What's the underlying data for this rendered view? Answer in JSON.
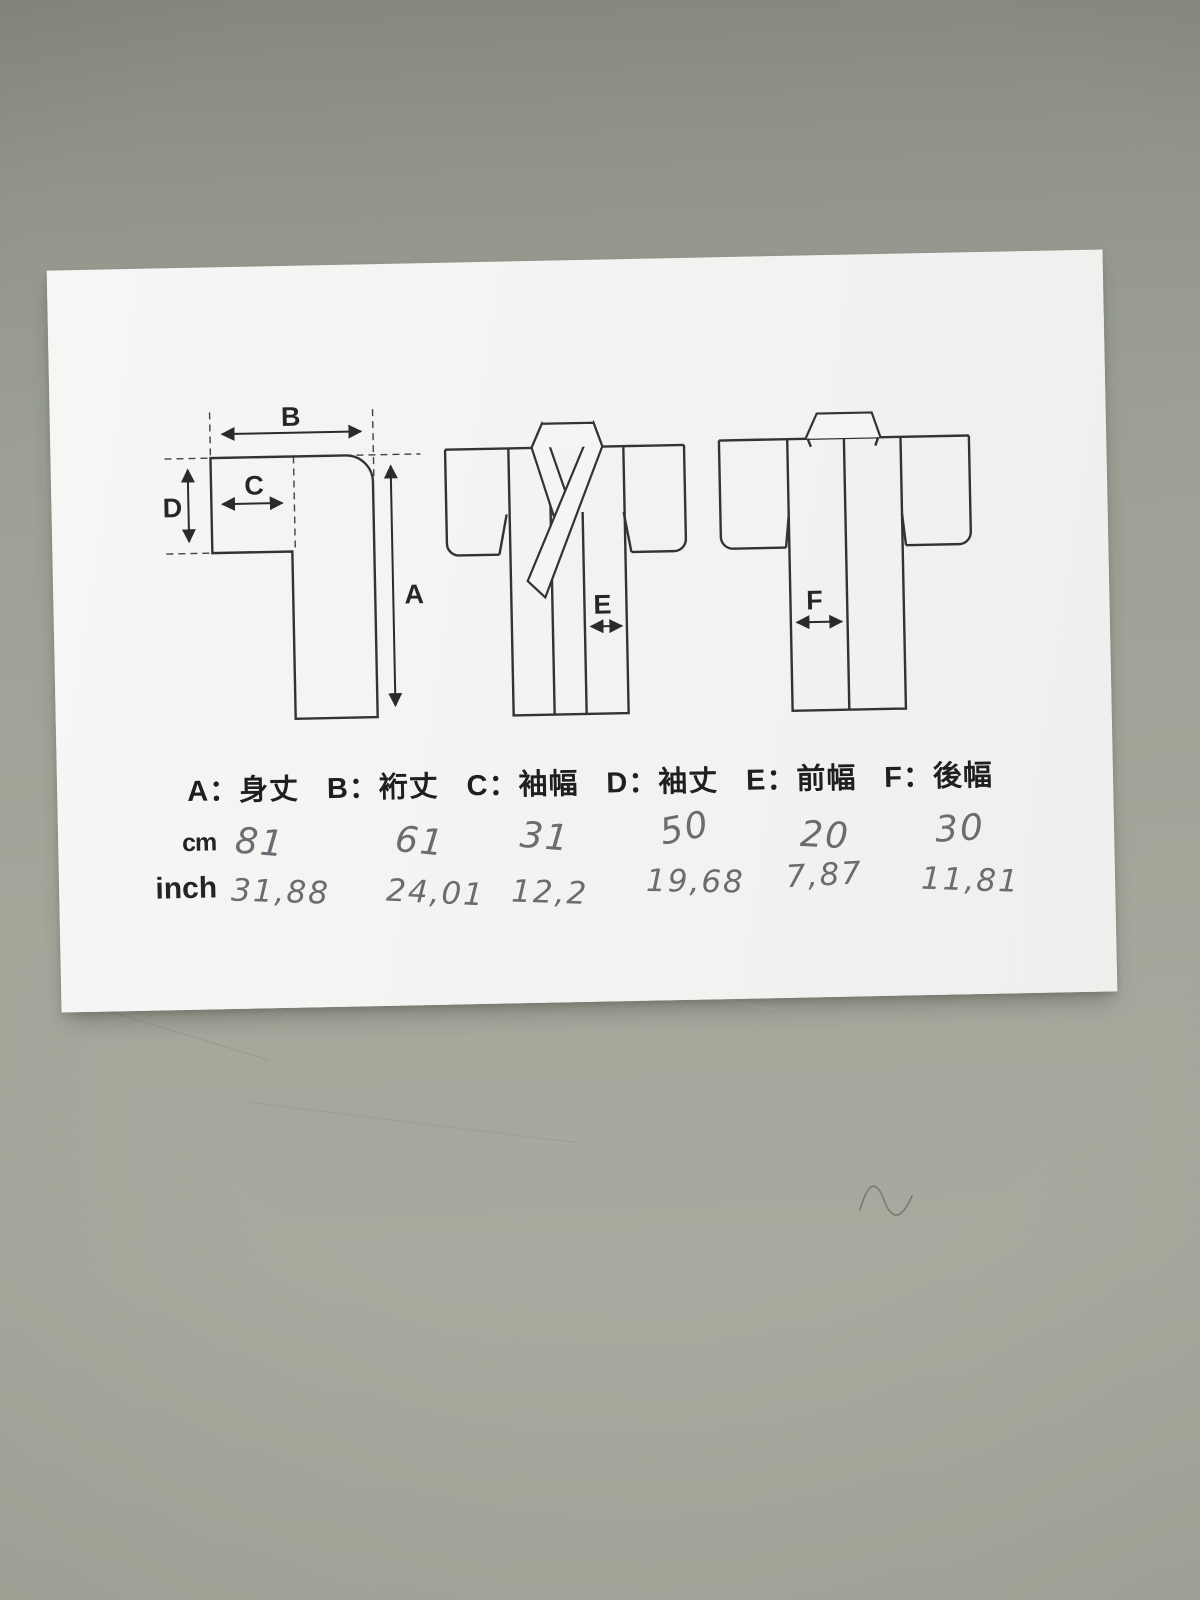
{
  "colors": {
    "table_surface": "#9a9d92",
    "paper": "#f4f3f1",
    "print_ink": "#222222",
    "pencil": "#63666a"
  },
  "diagram": {
    "letters": {
      "a": "A",
      "b": "B",
      "c": "C",
      "d": "D",
      "e": "E",
      "f": "F"
    }
  },
  "legend": {
    "items": [
      {
        "label": "A：身丈"
      },
      {
        "label": "B：裄丈"
      },
      {
        "label": "C：袖幅"
      },
      {
        "label": "D：袖丈"
      },
      {
        "label": "E：前幅"
      },
      {
        "label": "F：後幅"
      }
    ]
  },
  "measurements": {
    "rows": [
      {
        "unit": "cm",
        "values": [
          "81",
          "61",
          "31",
          "50",
          "20",
          "30"
        ]
      },
      {
        "unit": "inch",
        "values": [
          "31,88",
          "24,01",
          "12,2",
          "19,68",
          "7,87",
          "11,81"
        ]
      }
    ]
  }
}
